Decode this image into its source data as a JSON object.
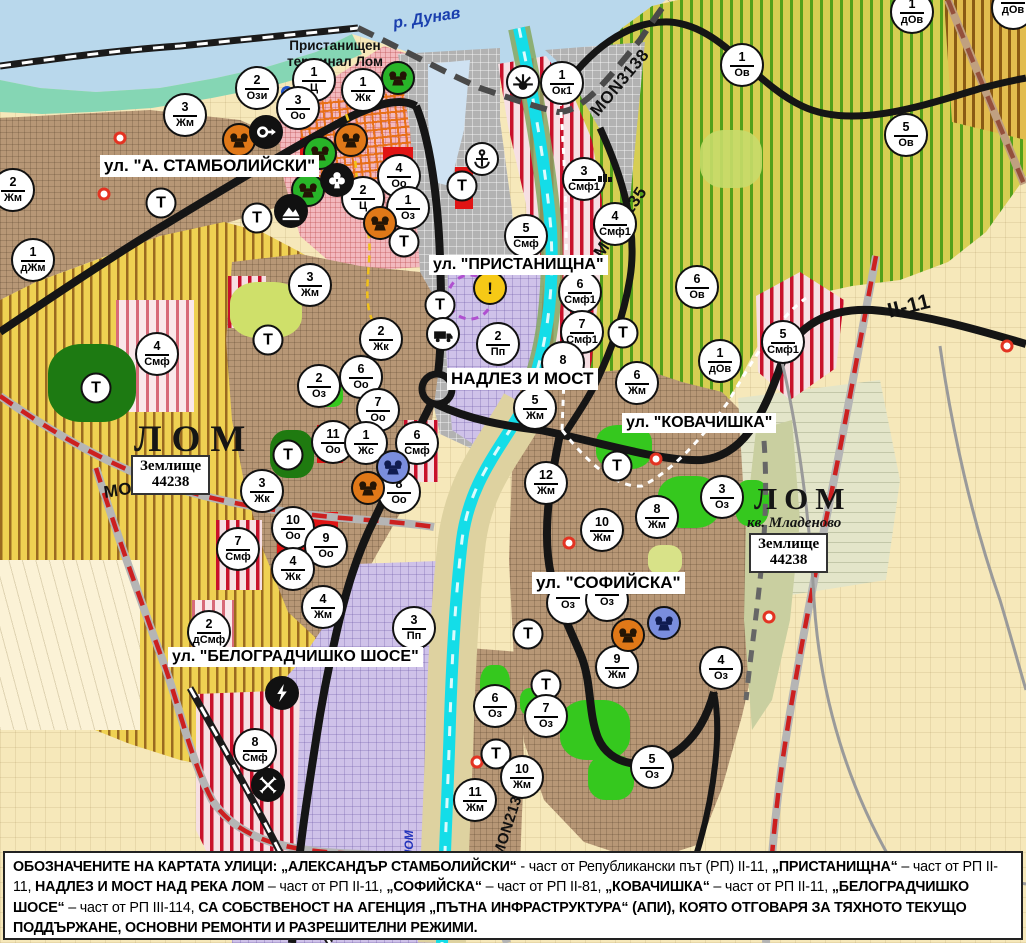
{
  "colors": {
    "water": "#b9d8ec",
    "cyan_river": "#14dde8",
    "road_black": "#151515",
    "road_red_dash": "#cc2020",
    "zone_green_stripe": "#53a01a",
    "zone_red_stripe": "#c8102a",
    "heritage_orange": "#e07818",
    "heritage_green": "#28b428",
    "heritage_blue": "#7a8ede",
    "warning_yellow": "#f6c916"
  },
  "texts": {
    "river": "р. Дунав",
    "port_terminal_lines": [
      "Пристанищен",
      "терминал Лом"
    ],
    "river_lom_vertical": "ЛОМ"
  },
  "city_labels": [
    {
      "text": "ЛОМ",
      "x": 134,
      "y": 418,
      "size": 37,
      "ls": 10
    },
    {
      "text": "ЛОМ",
      "x": 754,
      "y": 481,
      "size": 31,
      "ls": 7
    }
  ],
  "quarter_label": {
    "text": "кв. Младеново",
    "x": 747,
    "y": 515,
    "size": 15
  },
  "zemlishte_boxes": [
    {
      "x": 131,
      "y": 455,
      "lines": [
        "Землище",
        "44238"
      ]
    },
    {
      "x": 749,
      "y": 533,
      "lines": [
        "Землище",
        "44238"
      ]
    }
  ],
  "street_labels": [
    {
      "text": "ул. \"А. СТАМБОЛИЙСКИ\"",
      "x": 100,
      "y": 155,
      "size": 17
    },
    {
      "text": "ул. \"ПРИСТАНИЩНА\"",
      "x": 429,
      "y": 255,
      "size": 16
    },
    {
      "text": "НАДЛЕЗ И МОСТ",
      "x": 447,
      "y": 368,
      "size": 17
    },
    {
      "text": "ул. \"КОВАЧИШКА\"",
      "x": 622,
      "y": 413,
      "size": 16
    },
    {
      "text": "ул. \"СОФИЙСКА\"",
      "x": 532,
      "y": 572,
      "size": 17
    },
    {
      "text": "ул. \"БЕЛОГРАДЧИШКО ШОСЕ\"",
      "x": 168,
      "y": 647,
      "size": 16
    }
  ],
  "road_labels": [
    {
      "text": "MON3139",
      "x": 104,
      "y": 483,
      "rot": -9,
      "size": 17
    },
    {
      "text": "MON3138",
      "x": 594,
      "y": 104,
      "rot": -50,
      "size": 17
    },
    {
      "text": "MON2135",
      "x": 598,
      "y": 246,
      "rot": -56,
      "size": 17
    },
    {
      "text": "II-11",
      "x": 888,
      "y": 300,
      "rot": -14,
      "size": 21
    },
    {
      "text": "MON2136",
      "x": 498,
      "y": 848,
      "rot": -72,
      "size": 15
    }
  ],
  "markers": [
    {
      "x": 257,
      "y": 88,
      "n": "2",
      "c": "Ози"
    },
    {
      "x": 314,
      "y": 80,
      "n": "1",
      "c": "Ц"
    },
    {
      "x": 298,
      "y": 108,
      "n": "3",
      "c": "Оо"
    },
    {
      "x": 363,
      "y": 90,
      "n": "1",
      "c": "Жк"
    },
    {
      "x": 562,
      "y": 83,
      "n": "1",
      "c": "Ок1"
    },
    {
      "x": 185,
      "y": 115,
      "n": "3",
      "c": "Жм"
    },
    {
      "x": 13,
      "y": 190,
      "n": "2",
      "c": "Жм"
    },
    {
      "x": 33,
      "y": 260,
      "n": "1",
      "c": "дЖм"
    },
    {
      "x": 310,
      "y": 285,
      "n": "3",
      "c": "Жм"
    },
    {
      "x": 399,
      "y": 176,
      "n": "4",
      "c": "Оо"
    },
    {
      "x": 363,
      "y": 198,
      "n": "2",
      "c": "Ц"
    },
    {
      "x": 408,
      "y": 208,
      "n": "1",
      "c": "Оз"
    },
    {
      "x": 584,
      "y": 179,
      "n": "3",
      "c": "Смф1"
    },
    {
      "x": 526,
      "y": 236,
      "n": "5",
      "c": "Смф"
    },
    {
      "x": 615,
      "y": 224,
      "n": "4",
      "c": "Смф1"
    },
    {
      "x": 697,
      "y": 287,
      "n": "6",
      "c": "Ов"
    },
    {
      "x": 742,
      "y": 65,
      "n": "1",
      "c": "Ов"
    },
    {
      "x": 906,
      "y": 135,
      "n": "5",
      "c": "Ов"
    },
    {
      "x": 912,
      "y": 12,
      "n": "1",
      "c": "дОв"
    },
    {
      "x": 1013,
      "y": 8,
      "n": "",
      "c": "дОв"
    },
    {
      "x": 580,
      "y": 292,
      "n": "6",
      "c": "Смф1"
    },
    {
      "x": 582,
      "y": 332,
      "n": "7",
      "c": "Смф1"
    },
    {
      "x": 563,
      "y": 363,
      "n": "8",
      "c": ""
    },
    {
      "x": 498,
      "y": 344,
      "n": "2",
      "c": "Пп"
    },
    {
      "x": 535,
      "y": 408,
      "n": "5",
      "c": "Жм"
    },
    {
      "x": 637,
      "y": 383,
      "n": "6",
      "c": "Жм"
    },
    {
      "x": 546,
      "y": 483,
      "n": "12",
      "c": "Жм"
    },
    {
      "x": 602,
      "y": 530,
      "n": "10",
      "c": "Жм"
    },
    {
      "x": 657,
      "y": 517,
      "n": "8",
      "c": "Жм"
    },
    {
      "x": 722,
      "y": 497,
      "n": "3",
      "c": "Оз"
    },
    {
      "x": 783,
      "y": 342,
      "n": "5",
      "c": "Смф1"
    },
    {
      "x": 720,
      "y": 361,
      "n": "1",
      "c": "дОв"
    },
    {
      "x": 381,
      "y": 339,
      "n": "2",
      "c": "Жк"
    },
    {
      "x": 361,
      "y": 377,
      "n": "6",
      "c": "Оо"
    },
    {
      "x": 319,
      "y": 386,
      "n": "2",
      "c": "Оз"
    },
    {
      "x": 378,
      "y": 410,
      "n": "7",
      "c": "Оо"
    },
    {
      "x": 333,
      "y": 442,
      "n": "11",
      "c": "Оо"
    },
    {
      "x": 366,
      "y": 443,
      "n": "1",
      "c": "Жс"
    },
    {
      "x": 417,
      "y": 443,
      "n": "6",
      "c": "Смф"
    },
    {
      "x": 399,
      "y": 492,
      "n": "8",
      "c": "Оо"
    },
    {
      "x": 262,
      "y": 491,
      "n": "3",
      "c": "Жк"
    },
    {
      "x": 293,
      "y": 528,
      "n": "10",
      "c": "Оо"
    },
    {
      "x": 326,
      "y": 546,
      "n": "9",
      "c": "Оо"
    },
    {
      "x": 293,
      "y": 569,
      "n": "4",
      "c": "Жк"
    },
    {
      "x": 323,
      "y": 607,
      "n": "4",
      "c": "Жм"
    },
    {
      "x": 209,
      "y": 632,
      "n": "2",
      "c": "дСмф"
    },
    {
      "x": 238,
      "y": 549,
      "n": "7",
      "c": "Смф"
    },
    {
      "x": 414,
      "y": 628,
      "n": "3",
      "c": "Пп"
    },
    {
      "x": 157,
      "y": 354,
      "n": "4",
      "c": "Смф"
    },
    {
      "x": 255,
      "y": 750,
      "n": "8",
      "c": "Смф"
    },
    {
      "x": 568,
      "y": 603,
      "n": "",
      "c": "Оз"
    },
    {
      "x": 607,
      "y": 600,
      "n": "",
      "c": "Оз"
    },
    {
      "x": 617,
      "y": 667,
      "n": "9",
      "c": "Жм"
    },
    {
      "x": 721,
      "y": 668,
      "n": "4",
      "c": "Оз"
    },
    {
      "x": 495,
      "y": 706,
      "n": "6",
      "c": "Оз"
    },
    {
      "x": 546,
      "y": 716,
      "n": "7",
      "c": "Оз"
    },
    {
      "x": 652,
      "y": 767,
      "n": "5",
      "c": "Оз"
    },
    {
      "x": 522,
      "y": 777,
      "n": "10",
      "c": "Жм"
    },
    {
      "x": 475,
      "y": 800,
      "n": "11",
      "c": "Жм"
    }
  ],
  "t_markers": [
    [
      161,
      203
    ],
    [
      257,
      218
    ],
    [
      404,
      242
    ],
    [
      462,
      186
    ],
    [
      440,
      305
    ],
    [
      288,
      455
    ],
    [
      96,
      388
    ],
    [
      268,
      340
    ],
    [
      623,
      333
    ],
    [
      617,
      466
    ],
    [
      528,
      634
    ],
    [
      546,
      685
    ],
    [
      496,
      754
    ]
  ],
  "icons": [
    {
      "x": 398,
      "y": 78,
      "t": "heritage",
      "bg": "#28b428"
    },
    {
      "x": 523,
      "y": 82,
      "t": "sun",
      "bg": "#ffffff"
    },
    {
      "x": 482,
      "y": 159,
      "t": "anchor",
      "bg": "#ffffff"
    },
    {
      "x": 239,
      "y": 140,
      "t": "heritage",
      "bg": "#e07818"
    },
    {
      "x": 266,
      "y": 132,
      "t": "arrow",
      "bg": "#111111"
    },
    {
      "x": 320,
      "y": 153,
      "t": "heritage",
      "bg": "#28b428"
    },
    {
      "x": 351,
      "y": 140,
      "t": "heritage",
      "bg": "#e07818"
    },
    {
      "x": 308,
      "y": 190,
      "t": "heritage",
      "bg": "#28b428"
    },
    {
      "x": 337,
      "y": 180,
      "t": "trefoil",
      "bg": "#111111"
    },
    {
      "x": 291,
      "y": 211,
      "t": "mountain",
      "bg": "#111111"
    },
    {
      "x": 380,
      "y": 223,
      "t": "heritage",
      "bg": "#e07818"
    },
    {
      "x": 443,
      "y": 334,
      "t": "truck",
      "bg": "#ffffff"
    },
    {
      "x": 490,
      "y": 288,
      "t": "warning",
      "bg": "#f6c916"
    },
    {
      "x": 368,
      "y": 488,
      "t": "heritage",
      "bg": "#e07818"
    },
    {
      "x": 393,
      "y": 467,
      "t": "heritage",
      "bg": "#7a8ede"
    },
    {
      "x": 628,
      "y": 635,
      "t": "heritage",
      "bg": "#e07818"
    },
    {
      "x": 664,
      "y": 623,
      "t": "heritage",
      "bg": "#7a8ede"
    },
    {
      "x": 282,
      "y": 693,
      "t": "substation",
      "bg": "#111111"
    },
    {
      "x": 268,
      "y": 785,
      "t": "station",
      "bg": "#111111"
    },
    {
      "x": 605,
      "y": 178,
      "t": "works",
      "bg": "none"
    }
  ],
  "red_dots": [
    [
      120,
      138
    ],
    [
      104,
      194
    ],
    [
      656,
      459
    ],
    [
      569,
      543
    ],
    [
      477,
      762
    ],
    [
      769,
      617
    ],
    [
      1007,
      346
    ]
  ],
  "blue_dots": [
    [
      287,
      92
    ]
  ],
  "info_panel": {
    "segments": [
      {
        "t": "ОБОЗНАЧЕНИТЕ НА КАРТАТА УЛИЦИ: „АЛЕКСАНДЪР СТАМБОЛИЙСКИ“",
        "b": true
      },
      {
        "t": " - част от Републикански път (РП) II-11, ",
        "b": false
      },
      {
        "t": "„ПРИСТАНИЩНА“",
        "b": true
      },
      {
        "t": " – част от РП II-11, ",
        "b": false
      },
      {
        "t": "НАДЛЕЗ И МОСТ НАД РЕКА ЛОМ",
        "b": true
      },
      {
        "t": " – част от РП II-11, ",
        "b": false
      },
      {
        "t": "„СОФИЙСКА“",
        "b": true
      },
      {
        "t": " – част от РП II-81, ",
        "b": false
      },
      {
        "t": "„КОВАЧИШКА“",
        "b": true
      },
      {
        "t": " – част от РП II-11, ",
        "b": false
      },
      {
        "t": "„БЕЛОГРАДЧИШКО ШОСЕ“",
        "b": true
      },
      {
        "t": " – част от РП III-114, ",
        "b": false
      },
      {
        "t": "СА СОБСТВЕНОСТ НА АГЕНЦИЯ „ПЪТНА ИНФРАСТРУКТУРА“ (АПИ), КОЯТО ОТГОВАРЯ ЗА ТЯХНОТО ТЕКУЩО ПОДДЪРЖАНЕ, ОСНОВНИ РЕМОНТИ И РАЗРЕШИТЕЛНИ РЕЖИМИ.",
        "b": true
      }
    ]
  }
}
